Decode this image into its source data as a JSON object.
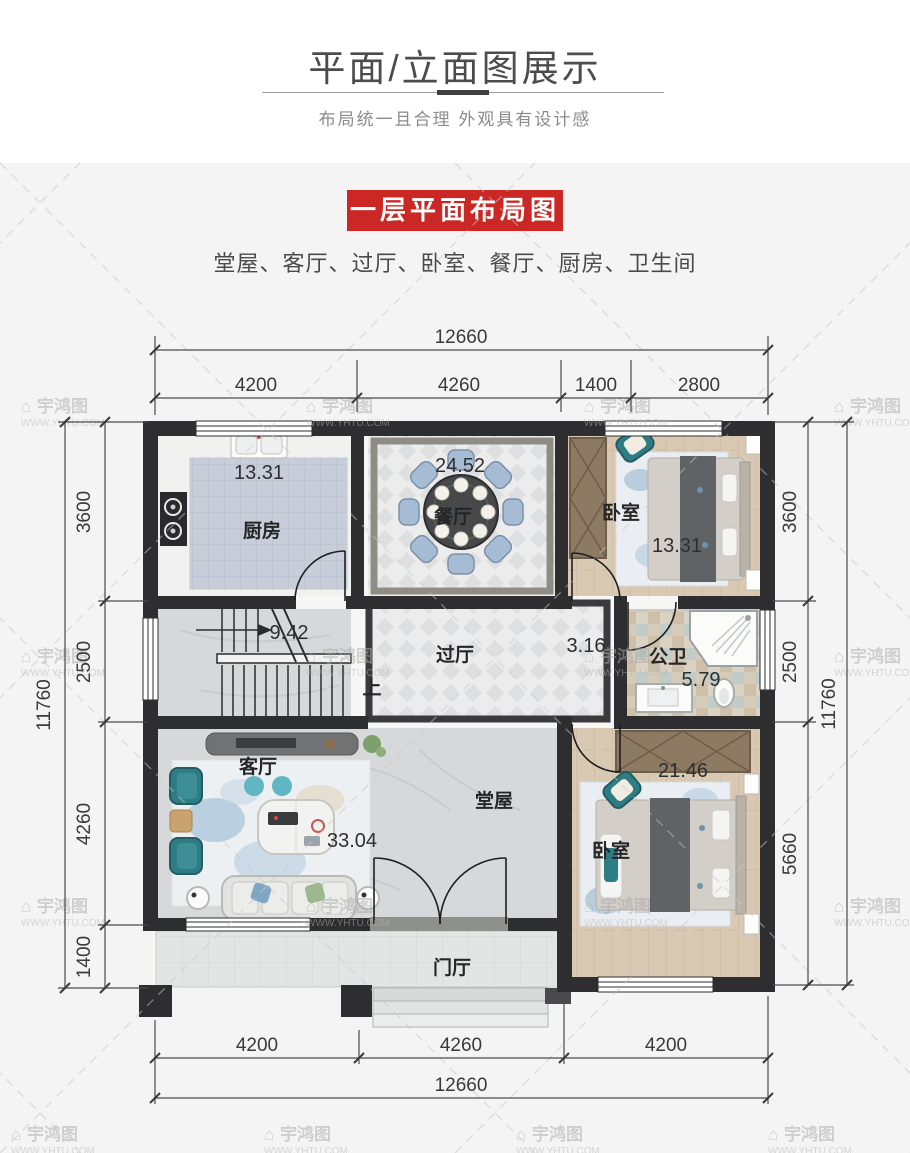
{
  "header": {
    "title": "平面/立面图展示",
    "subtitle": "布局统一且合理  外观具有设计感"
  },
  "section": {
    "banner": "一层平面布局图",
    "room_list": "堂屋、客厅、过厅、卧室、餐厅、厨房、卫生间"
  },
  "floor_plan": {
    "dimensions": {
      "top_total": "12660",
      "top_segments": [
        "4200",
        "4260",
        "1400",
        "2800"
      ],
      "bottom_segments": [
        "4200",
        "4260",
        "4200"
      ],
      "bottom_total": "12660",
      "left_segments": [
        "3600",
        "2500",
        "4260",
        "1400"
      ],
      "left_total": "11760",
      "right_segments": [
        "3600",
        "2500",
        "5660"
      ],
      "right_total": "11760"
    },
    "rooms": {
      "kitchen": {
        "name": "厨房",
        "area": "13.31"
      },
      "dining": {
        "name": "餐厅",
        "area": "24.52"
      },
      "bedroom_top": {
        "name": "卧室",
        "area": "13.31"
      },
      "stairs": {
        "area": "9.42",
        "up_label": "上"
      },
      "hallway": {
        "name": "过厅",
        "area": "3.16"
      },
      "bathroom": {
        "name": "公卫",
        "area": "5.79"
      },
      "living": {
        "name": "客厅"
      },
      "hall": {
        "name": "堂屋",
        "area": "33.04"
      },
      "bedroom_bottom": {
        "name": "卧室",
        "area": "21.46"
      },
      "foyer": {
        "name": "门厅"
      }
    }
  },
  "watermark": {
    "icon": "⌂",
    "brand": "宇鸿图",
    "url": "WWW.YHTU.COM"
  },
  "colors": {
    "banner_red": "#cb2724",
    "wall_dark": "#2e2e30",
    "accent_teal": "#2f7d84",
    "wood_floor": "#d9c8b2",
    "kitchen_tile": "#c7ced9",
    "marble": "#d6d8da",
    "watermark_gray": "#b0b0b0"
  }
}
